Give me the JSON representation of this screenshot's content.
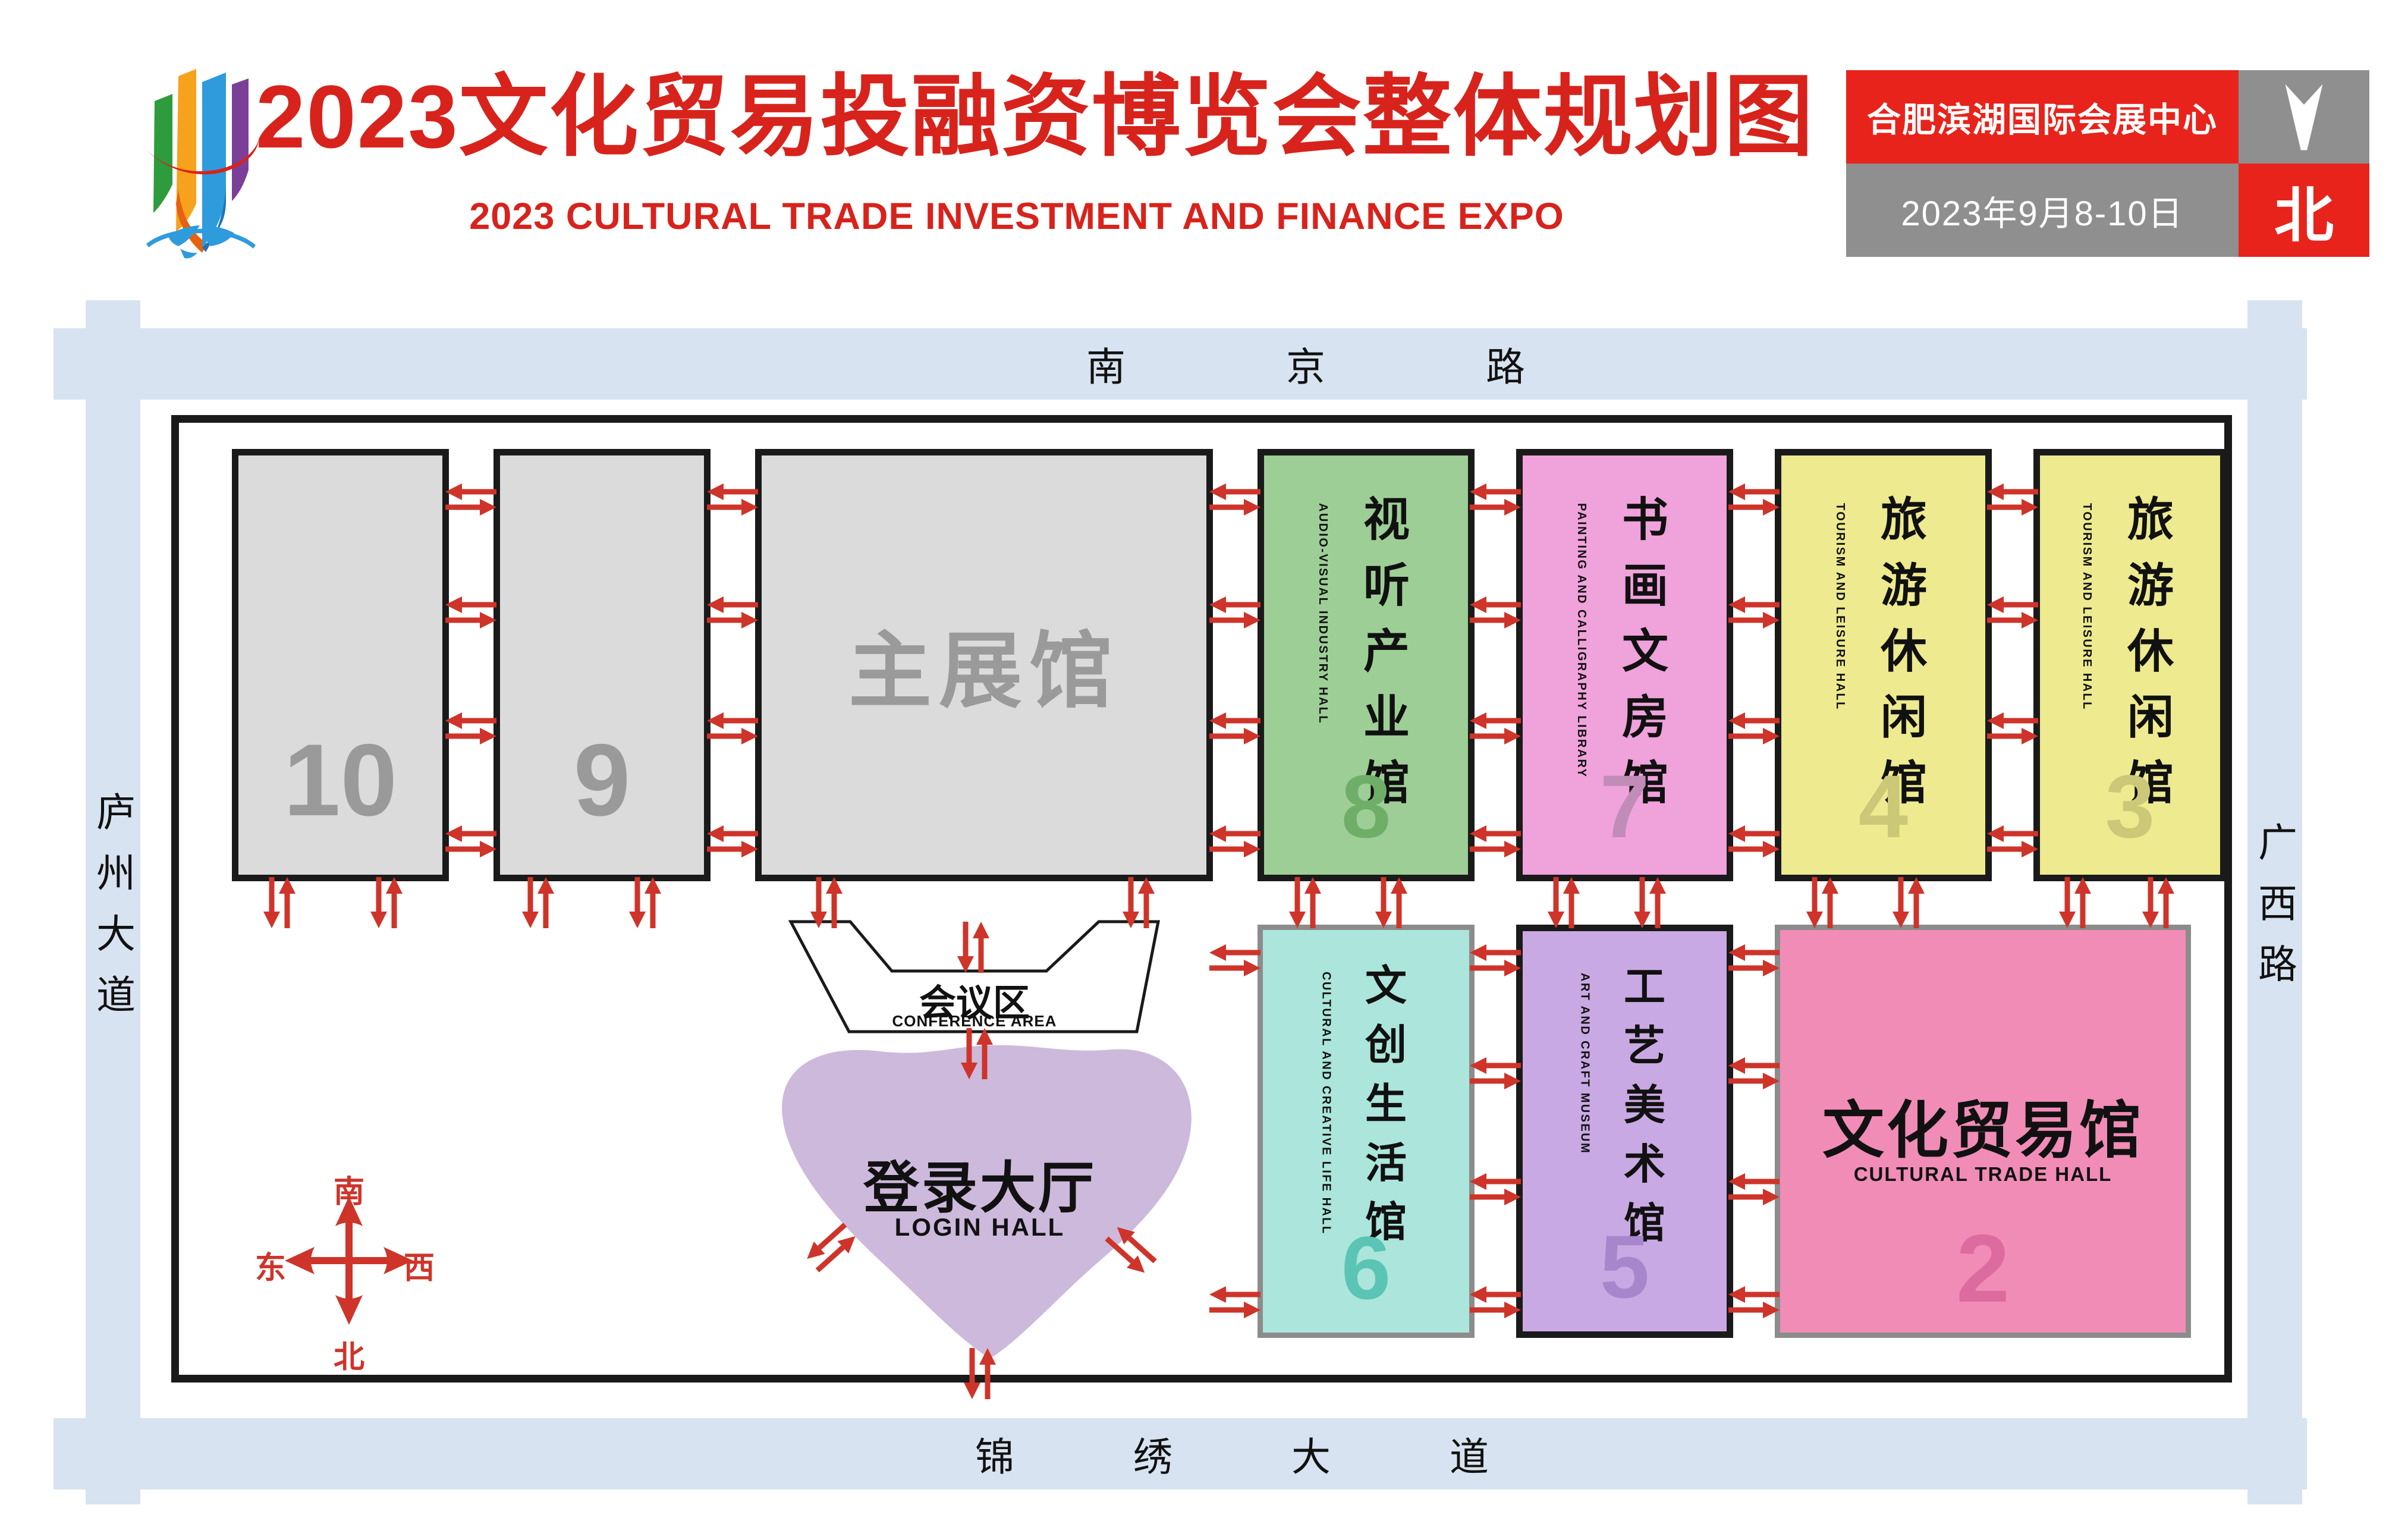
{
  "header": {
    "title_zh": "2023文化贸易投融资博览会整体规划图",
    "title_en": "2023 CULTURAL TRADE INVESTMENT AND FINANCE EXPO",
    "accent_red": "#D7231C",
    "info": {
      "venue_name": "合肥滨湖国际会展中心",
      "dates": "2023年9月8-10日",
      "north_label": "北",
      "north_arrow_icon": "down-arrowhead-icon",
      "red": "#E8231B",
      "gray": "#8F8F8F"
    }
  },
  "roads": {
    "color": "#D7E3F0",
    "top": "南京路",
    "bottom": "锦绣大道",
    "left": "庐州大道",
    "right": "广西路"
  },
  "compass": {
    "color": "#CE342A",
    "south": "南",
    "north": "北",
    "east": "东",
    "west": "西"
  },
  "areas": {
    "conference": {
      "name_zh": "会议区",
      "name_en": "CONFERENCE AREA",
      "fill": "#ffffff",
      "outline": "#1A1A1A"
    },
    "login": {
      "name_zh": "登录大厅",
      "name_en": "LOGIN HALL",
      "fill": "#CDB9DC"
    }
  },
  "halls": {
    "main": {
      "name_zh": "主展馆",
      "fill": "#DBDBDB",
      "text_color": "#9A9A9A",
      "border": "#1A1A1A"
    },
    "h10": {
      "number": "10",
      "fill": "#DBDBDB",
      "num_color": "#9A9A9A",
      "border": "#1A1A1A"
    },
    "h9": {
      "number": "9",
      "fill": "#DBDBDB",
      "num_color": "#9A9A9A",
      "border": "#1A1A1A"
    },
    "h8": {
      "number": "8",
      "name_zh": "视听产业馆",
      "name_en": "AUDIO-VISUAL INDUSTRY HALL",
      "fill": "#9DCE96",
      "num_color": "#6FAE69",
      "border": "#1A1A1A"
    },
    "h7": {
      "number": "7",
      "name_zh": "书画文房馆",
      "name_en": "PAINTING AND CALLIGRAPHY LIBRARY",
      "fill": "#F0A2DB",
      "num_color": "#C18CB8",
      "border": "#1A1A1A"
    },
    "h4": {
      "number": "4",
      "name_zh": "旅游休闲馆",
      "name_en": "TOURISM AND LEISURE HALL",
      "fill": "#EDEA8F",
      "num_color": "#CBC878",
      "border": "#1A1A1A"
    },
    "h3": {
      "number": "3",
      "name_zh": "旅游休闲馆",
      "name_en": "TOURISM AND LEISURE HALL",
      "fill": "#EDEA8F",
      "num_color": "#CBC878",
      "border": "#1A1A1A"
    },
    "h6": {
      "number": "6",
      "name_zh": "文创生活馆",
      "name_en": "CULTURAL AND CREATIVE LIFE HALL",
      "fill": "#ABE5DB",
      "num_color": "#5BC4B4",
      "border": "#8C8C8C"
    },
    "h5": {
      "number": "5",
      "name_zh": "工艺美术馆",
      "name_en": "ART AND CRAFT MUSEUM",
      "fill": "#C9A9E3",
      "num_color": "#A687CC",
      "border": "#1A1A1A"
    },
    "h2": {
      "number": "2",
      "name_zh": "文化贸易馆",
      "name_en": "CULTURAL TRADE HALL",
      "fill": "#F18CB7",
      "num_color": "#DC6B9F",
      "border": "#8C8C8C"
    }
  },
  "arrow_color": "#CE342A"
}
